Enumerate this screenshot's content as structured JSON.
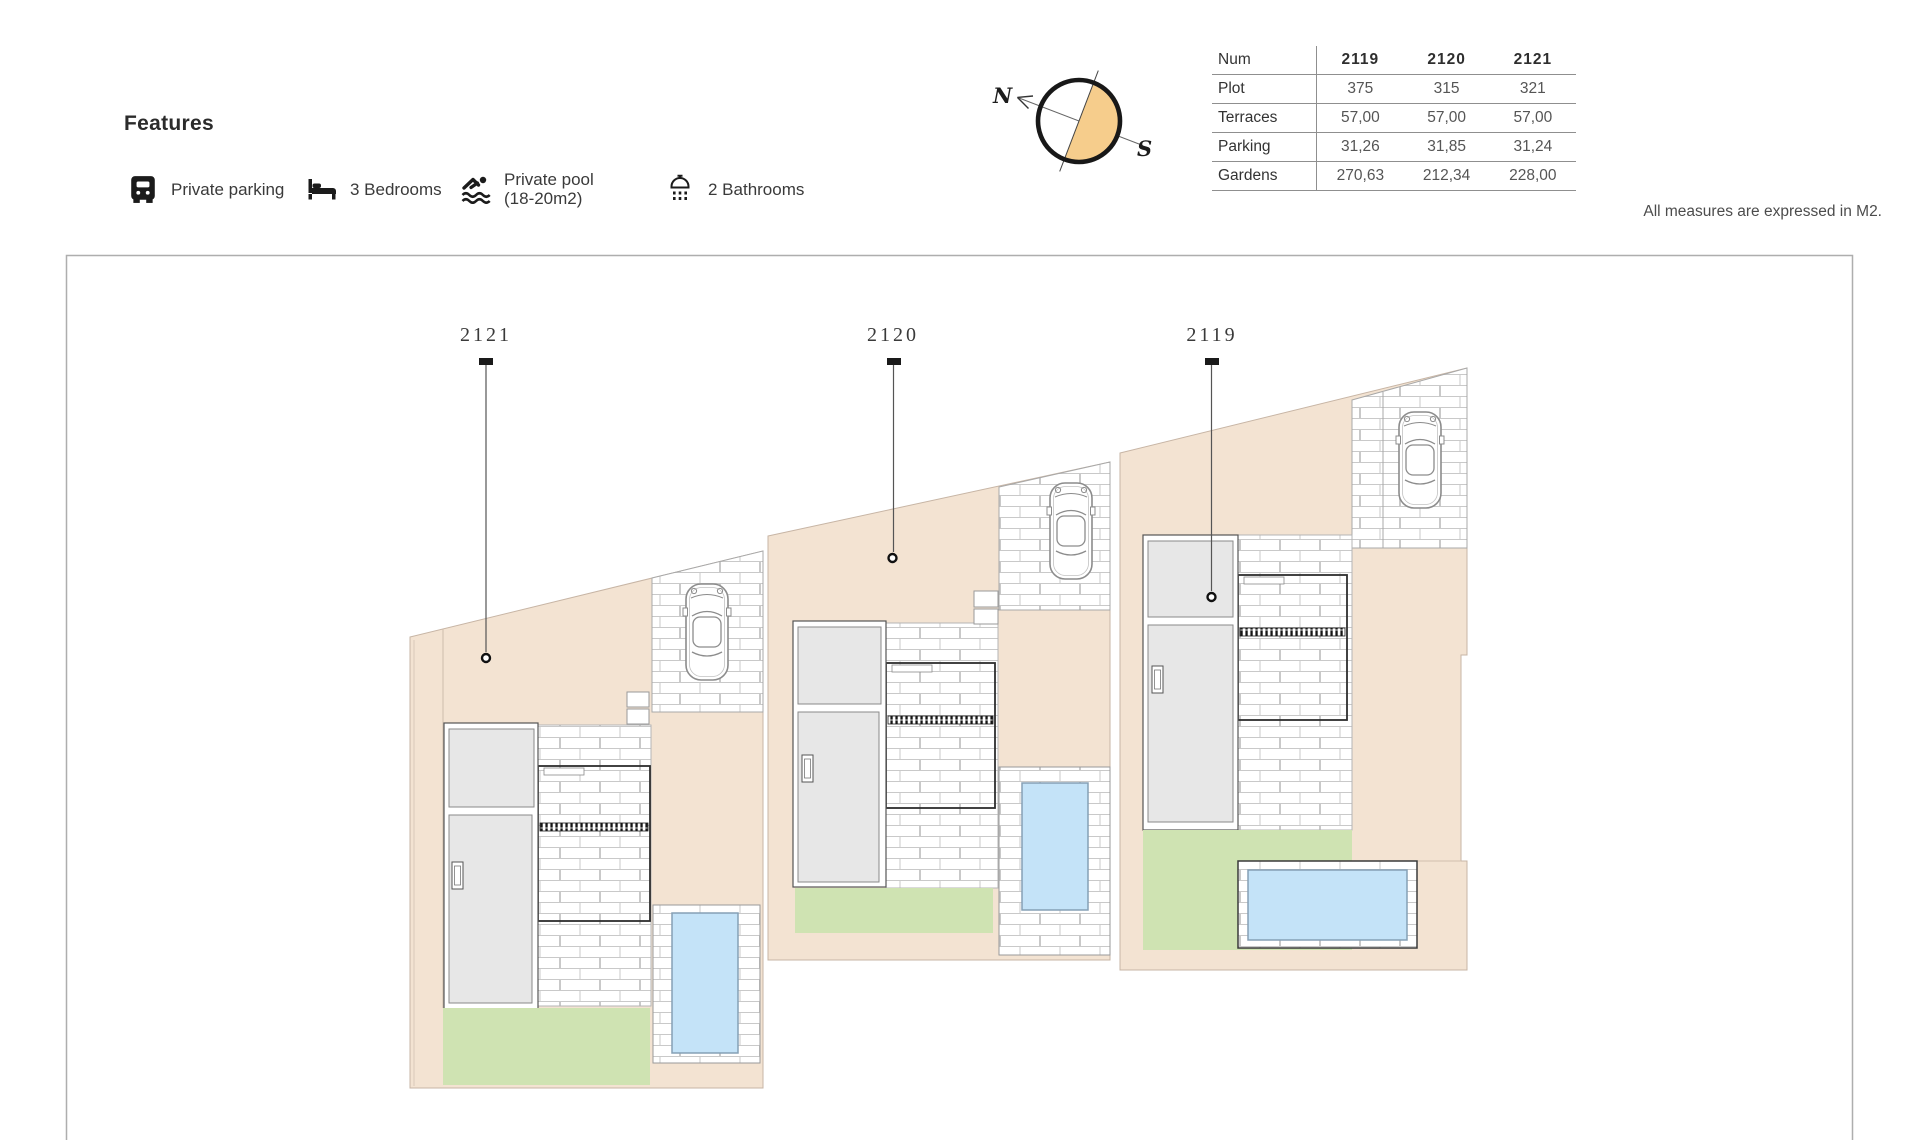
{
  "features": {
    "title": "Features",
    "items": [
      {
        "icon": "parking-icon",
        "label": "Private parking"
      },
      {
        "icon": "bed-icon",
        "label": "3 Bedrooms"
      },
      {
        "icon": "swimmer-icon",
        "label": "Private pool (18-20m2)",
        "label_line1": "Private pool",
        "label_line2": "(18-20m2)"
      },
      {
        "icon": "shower-icon",
        "label": "2 Bathrooms"
      }
    ]
  },
  "compass": {
    "north_label": "N",
    "south_label": "S",
    "accent_color": "#f6cd8c"
  },
  "table": {
    "col_header": "Num",
    "columns": [
      "2119",
      "2120",
      "2121"
    ],
    "rows": [
      {
        "label": "Plot",
        "values": [
          "375",
          "315",
          "321"
        ]
      },
      {
        "label": "Terraces",
        "values": [
          "57,00",
          "57,00",
          "57,00"
        ]
      },
      {
        "label": "Parking",
        "values": [
          "31,26",
          "31,85",
          "31,24"
        ]
      },
      {
        "label": "Gardens",
        "values": [
          "270,63",
          "212,34",
          "228,00"
        ]
      }
    ]
  },
  "note": "All measures are expressed in M2.",
  "plan": {
    "plots": [
      {
        "label": "2121"
      },
      {
        "label": "2120"
      },
      {
        "label": "2119"
      }
    ]
  },
  "colors": {
    "terrain_beige": "#f3e3d2",
    "lawn_green": "#cfe3b2",
    "pool_blue": "#c4e3f8",
    "building_grey": "#e7e7e7",
    "compass_orange": "#f6cd8c"
  }
}
